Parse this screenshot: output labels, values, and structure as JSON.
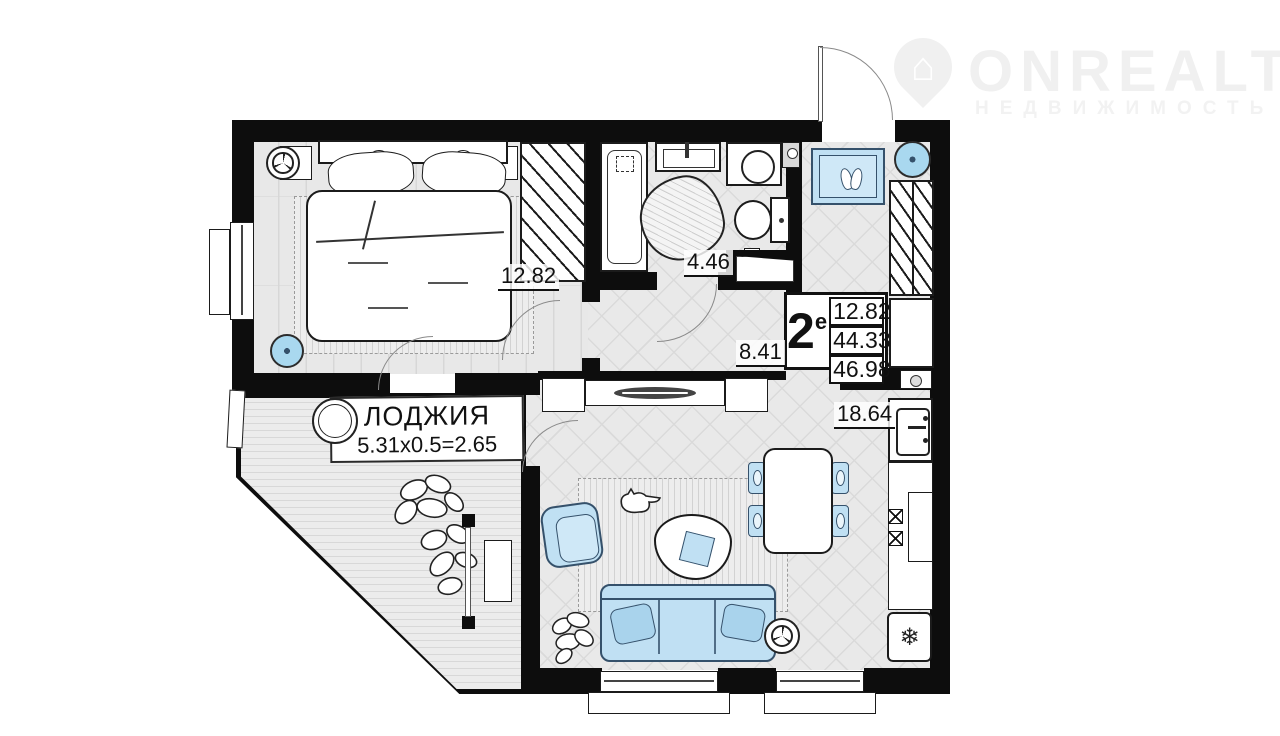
{
  "watermark": {
    "brand": "ONREALT",
    "subtitle": "НЕДВИЖИМОСТЬ"
  },
  "rooms": {
    "bedroom": {
      "name": "bedroom",
      "area": "12.82"
    },
    "bathroom": {
      "name": "bathroom",
      "area": "4.46"
    },
    "hall": {
      "name": "hall",
      "area": "8.41"
    },
    "kitchen_living": {
      "name": "kitchen-living",
      "area": "18.64"
    }
  },
  "spec": {
    "type": "2",
    "sup": "е",
    "areas": [
      "12.82",
      "44.33",
      "46.98"
    ]
  },
  "loggia": {
    "title": "ЛОДЖИЯ",
    "calc": "5.31x0.5=2.65"
  },
  "glyphs": {
    "house": "⌂",
    "snowflake": "❄"
  },
  "colors": {
    "wall": "#0d0d0d",
    "accent_blue": "#c0e0f3",
    "floor": "#e9e9e9",
    "watermark": "#f0f0f0"
  }
}
